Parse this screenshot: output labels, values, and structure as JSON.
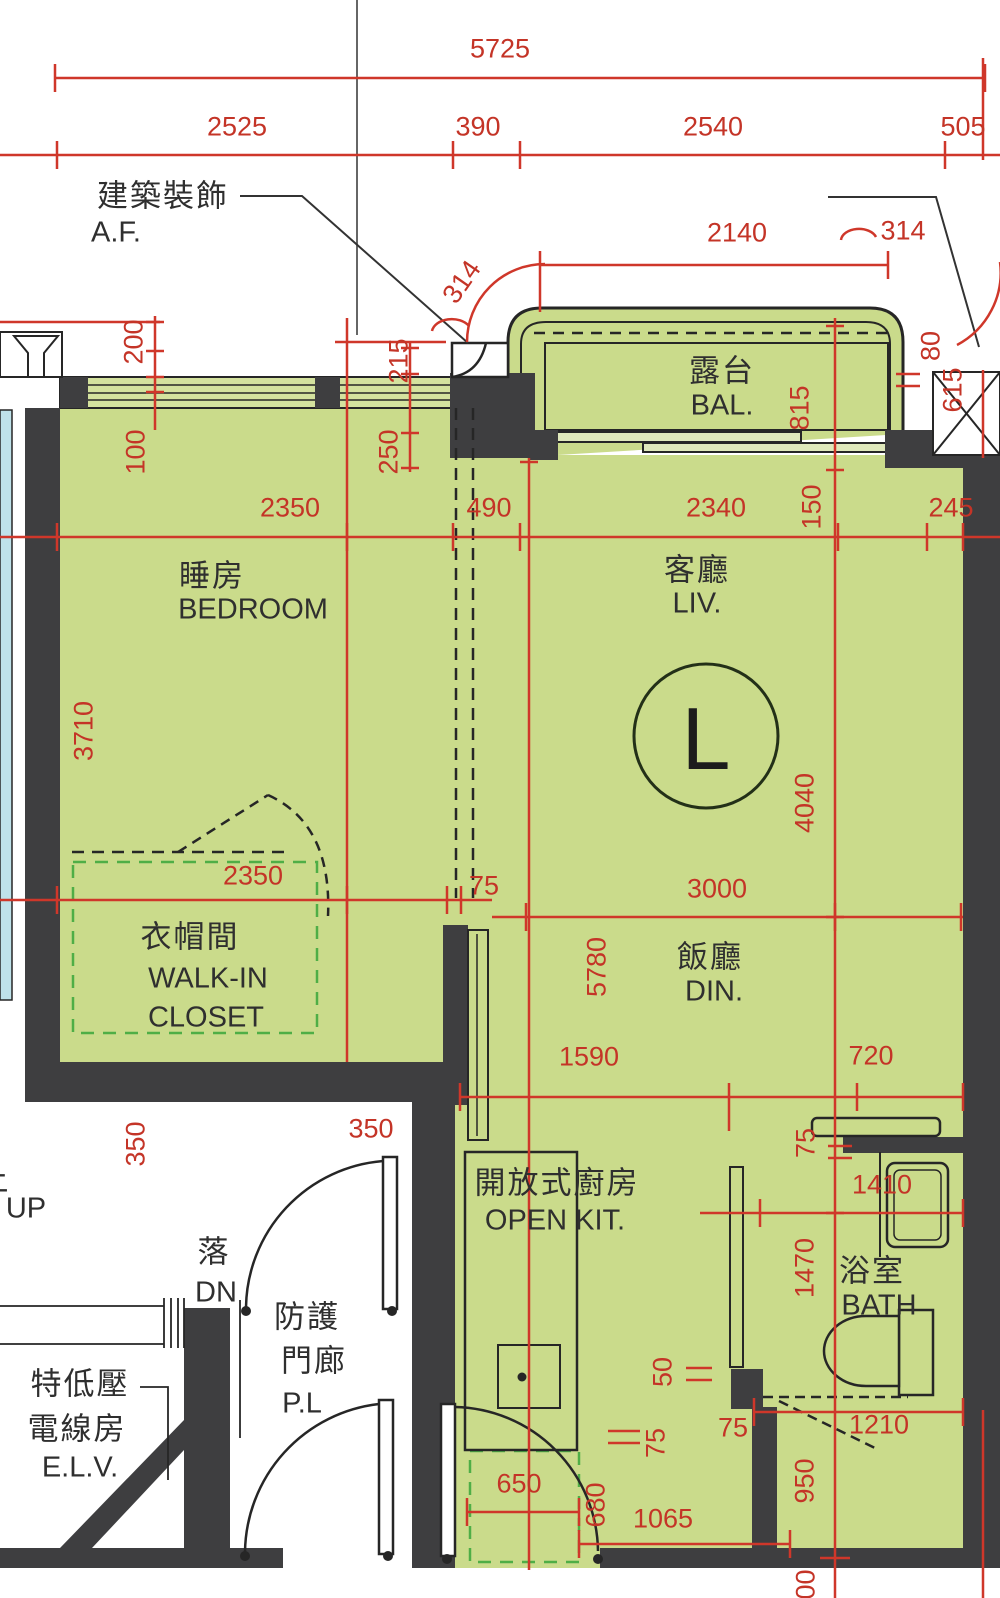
{
  "meta": {
    "drawing_type": "residential floor plan",
    "unit_label": "L"
  },
  "colors": {
    "floor_green": "#cadb8b",
    "window_band_green": "#d4e29e",
    "wall_dark": "#3e3e40",
    "dimension_red": "#cf372a",
    "dimension_text_red": "#c43427",
    "closet_dashed_green": "#4fae46",
    "adjacent_glazing_cyan": "#bfe2ea",
    "line_black": "#262626"
  },
  "rooms": [
    {
      "name_zh": "露台",
      "name_en": "BAL."
    },
    {
      "name_zh": "睡房",
      "name_en": "BEDROOM"
    },
    {
      "name_zh": "客廳",
      "name_en": "LIV."
    },
    {
      "name_zh": "飯廳",
      "name_en": "DIN."
    },
    {
      "name_zh": "衣帽間",
      "name_en": "WALK-IN CLOSET"
    },
    {
      "name_zh": "開放式廚房",
      "name_en": "OPEN KIT."
    },
    {
      "name_zh": "浴室",
      "name_en": "BATH"
    },
    {
      "name_zh": "防護門廊",
      "name_en": "P.L"
    },
    {
      "name_zh": "特低壓電線房",
      "name_en": "E.L.V."
    }
  ],
  "annotations": {
    "architectural_feature_zh": "建築裝飾",
    "architectural_feature_en": "A.F.",
    "stair_up": "UP",
    "stair_down_zh": "落",
    "stair_down_en": "DN",
    "unit_circle": "L"
  },
  "dimensions_mm": [
    5725,
    2525,
    390,
    2540,
    505,
    2140,
    314,
    314,
    215,
    200,
    100,
    250,
    815,
    80,
    615,
    150,
    2350,
    490,
    2340,
    245,
    3710,
    4040,
    2350,
    75,
    3000,
    5780,
    1590,
    720,
    75,
    1410,
    1470,
    350,
    350,
    50,
    75,
    75,
    1210,
    950,
    650,
    680,
    1065,
    100
  ],
  "labels": [
    {
      "name": "dim-5725",
      "text": "5725",
      "x": 500,
      "y": 49,
      "rot": 0,
      "cls": "dim"
    },
    {
      "name": "dim-2525",
      "text": "2525",
      "x": 237,
      "y": 127,
      "rot": 0,
      "cls": "dim"
    },
    {
      "name": "dim-390",
      "text": "390",
      "x": 478,
      "y": 127,
      "rot": 0,
      "cls": "dim"
    },
    {
      "name": "dim-2540",
      "text": "2540",
      "x": 713,
      "y": 127,
      "rot": 0,
      "cls": "dim"
    },
    {
      "name": "dim-505",
      "text": "505",
      "x": 963,
      "y": 127,
      "rot": 0,
      "cls": "dim"
    },
    {
      "name": "dim-2140",
      "text": "2140",
      "x": 737,
      "y": 233,
      "rot": 0,
      "cls": "dim"
    },
    {
      "name": "dim-314-right",
      "text": "314",
      "x": 903,
      "y": 231,
      "rot": 0,
      "cls": "dim"
    },
    {
      "name": "dim-314-left",
      "text": "314",
      "x": 462,
      "y": 282,
      "rot": -55,
      "cls": "dim"
    },
    {
      "name": "dim-215",
      "text": "215",
      "x": 399,
      "y": 361,
      "rot": -90,
      "cls": "dim"
    },
    {
      "name": "dim-200",
      "text": "200",
      "x": 134,
      "y": 342,
      "rot": -90,
      "cls": "dim"
    },
    {
      "name": "dim-100-top",
      "text": "100",
      "x": 136,
      "y": 452,
      "rot": -90,
      "cls": "dim"
    },
    {
      "name": "dim-250",
      "text": "250",
      "x": 389,
      "y": 452,
      "rot": -90,
      "cls": "dim"
    },
    {
      "name": "dim-815",
      "text": "815",
      "x": 800,
      "y": 408,
      "rot": -90,
      "cls": "dim"
    },
    {
      "name": "dim-80",
      "text": "80",
      "x": 931,
      "y": 346,
      "rot": -90,
      "cls": "dim"
    },
    {
      "name": "dim-615",
      "text": "615",
      "x": 953,
      "y": 390,
      "rot": -90,
      "cls": "dim"
    },
    {
      "name": "dim-150",
      "text": "150",
      "x": 812,
      "y": 507,
      "rot": -90,
      "cls": "dim"
    },
    {
      "name": "dim-2350-bedroom",
      "text": "2350",
      "x": 290,
      "y": 508,
      "rot": 0,
      "cls": "dim"
    },
    {
      "name": "dim-490",
      "text": "490",
      "x": 489,
      "y": 508,
      "rot": 0,
      "cls": "dim"
    },
    {
      "name": "dim-2340",
      "text": "2340",
      "x": 716,
      "y": 508,
      "rot": 0,
      "cls": "dim"
    },
    {
      "name": "dim-245",
      "text": "245",
      "x": 951,
      "y": 508,
      "rot": 0,
      "cls": "dim"
    },
    {
      "name": "dim-3710",
      "text": "3710",
      "x": 84,
      "y": 731,
      "rot": -90,
      "cls": "dim"
    },
    {
      "name": "dim-4040",
      "text": "4040",
      "x": 805,
      "y": 803,
      "rot": -90,
      "cls": "dim"
    },
    {
      "name": "dim-2350-closet",
      "text": "2350",
      "x": 253,
      "y": 876,
      "rot": 0,
      "cls": "dim"
    },
    {
      "name": "dim-75-closet",
      "text": "75",
      "x": 484,
      "y": 886,
      "rot": 0,
      "cls": "dim"
    },
    {
      "name": "dim-3000",
      "text": "3000",
      "x": 717,
      "y": 889,
      "rot": 0,
      "cls": "dim"
    },
    {
      "name": "dim-5780",
      "text": "5780",
      "x": 597,
      "y": 967,
      "rot": -90,
      "cls": "dim"
    },
    {
      "name": "dim-1590",
      "text": "1590",
      "x": 589,
      "y": 1057,
      "rot": 0,
      "cls": "dim"
    },
    {
      "name": "dim-720",
      "text": "720",
      "x": 871,
      "y": 1056,
      "rot": 0,
      "cls": "dim"
    },
    {
      "name": "dim-75-bath-top",
      "text": "75",
      "x": 806,
      "y": 1143,
      "rot": -90,
      "cls": "dim"
    },
    {
      "name": "dim-1410",
      "text": "1410",
      "x": 882,
      "y": 1185,
      "rot": 0,
      "cls": "dim"
    },
    {
      "name": "dim-1470",
      "text": "1470",
      "x": 805,
      "y": 1268,
      "rot": -90,
      "cls": "dim"
    },
    {
      "name": "dim-350-left",
      "text": "350",
      "x": 136,
      "y": 1144,
      "rot": -90,
      "cls": "dim"
    },
    {
      "name": "dim-350-right",
      "text": "350",
      "x": 371,
      "y": 1129,
      "rot": 0,
      "cls": "dim"
    },
    {
      "name": "dim-50",
      "text": "50",
      "x": 663,
      "y": 1372,
      "rot": -90,
      "cls": "dim"
    },
    {
      "name": "dim-75-door",
      "text": "75",
      "x": 656,
      "y": 1443,
      "rot": -90,
      "cls": "dim"
    },
    {
      "name": "dim-75-bathwall",
      "text": "75",
      "x": 733,
      "y": 1428,
      "rot": 0,
      "cls": "dim"
    },
    {
      "name": "dim-1210",
      "text": "1210",
      "x": 879,
      "y": 1425,
      "rot": 0,
      "cls": "dim"
    },
    {
      "name": "dim-950",
      "text": "950",
      "x": 805,
      "y": 1481,
      "rot": -90,
      "cls": "dim"
    },
    {
      "name": "dim-650",
      "text": "650",
      "x": 519,
      "y": 1484,
      "rot": 0,
      "cls": "dim"
    },
    {
      "name": "dim-680",
      "text": "680",
      "x": 596,
      "y": 1505,
      "rot": -90,
      "cls": "dim"
    },
    {
      "name": "dim-1065",
      "text": "1065",
      "x": 663,
      "y": 1519,
      "rot": 0,
      "cls": "dim"
    },
    {
      "name": "dim-100-bottom",
      "text": "100",
      "x": 806,
      "y": 1592,
      "rot": -90,
      "cls": "dim"
    },
    {
      "name": "label-af-zh",
      "text": "建築裝飾",
      "x": 163,
      "y": 196,
      "rot": 0,
      "cls": "zh"
    },
    {
      "name": "label-af-en",
      "text": "A.F.",
      "x": 116,
      "y": 233,
      "rot": 0,
      "cls": "en"
    },
    {
      "name": "label-bal-zh",
      "text": "露台",
      "x": 722,
      "y": 371,
      "rot": 0,
      "cls": "zh"
    },
    {
      "name": "label-bal-en",
      "text": "BAL.",
      "x": 722,
      "y": 406,
      "rot": 0,
      "cls": "en"
    },
    {
      "name": "label-bedroom-zh",
      "text": "睡房",
      "x": 212,
      "y": 576,
      "rot": 0,
      "cls": "zh"
    },
    {
      "name": "label-bedroom-en",
      "text": "BEDROOM",
      "x": 253,
      "y": 610,
      "rot": 0,
      "cls": "en"
    },
    {
      "name": "label-liv-zh",
      "text": "客廳",
      "x": 697,
      "y": 570,
      "rot": 0,
      "cls": "zh"
    },
    {
      "name": "label-liv-en",
      "text": "LIV.",
      "x": 697,
      "y": 604,
      "rot": 0,
      "cls": "en"
    },
    {
      "name": "label-unit-circle",
      "text": "L",
      "x": 706,
      "y": 739,
      "rot": 0,
      "cls": "big"
    },
    {
      "name": "label-din-zh",
      "text": "飯廳",
      "x": 710,
      "y": 957,
      "rot": 0,
      "cls": "zh"
    },
    {
      "name": "label-din-en",
      "text": "DIN.",
      "x": 714,
      "y": 992,
      "rot": 0,
      "cls": "en"
    },
    {
      "name": "label-closet-zh",
      "text": "衣帽間",
      "x": 190,
      "y": 937,
      "rot": 0,
      "cls": "zh"
    },
    {
      "name": "label-closet-en1",
      "text": "WALK-IN",
      "x": 208,
      "y": 979,
      "rot": 0,
      "cls": "en"
    },
    {
      "name": "label-closet-en2",
      "text": "CLOSET",
      "x": 206,
      "y": 1018,
      "rot": 0,
      "cls": "en"
    },
    {
      "name": "label-kitchen-zh",
      "text": "開放式廚房",
      "x": 557,
      "y": 1183,
      "rot": 0,
      "cls": "zh"
    },
    {
      "name": "label-kitchen-en",
      "text": "OPEN KIT.",
      "x": 555,
      "y": 1221,
      "rot": 0,
      "cls": "en"
    },
    {
      "name": "label-bath-zh",
      "text": "浴室",
      "x": 872,
      "y": 1271,
      "rot": 0,
      "cls": "zh"
    },
    {
      "name": "label-bath-en",
      "text": "BATH",
      "x": 879,
      "y": 1306,
      "rot": 0,
      "cls": "en"
    },
    {
      "name": "label-pl-zh1",
      "text": "防護",
      "x": 307,
      "y": 1317,
      "rot": 0,
      "cls": "zh"
    },
    {
      "name": "label-pl-zh2",
      "text": "門廊",
      "x": 314,
      "y": 1361,
      "rot": 0,
      "cls": "zh"
    },
    {
      "name": "label-pl-en",
      "text": "P.L",
      "x": 302,
      "y": 1404,
      "rot": 0,
      "cls": "en"
    },
    {
      "name": "label-elv-zh1",
      "text": "特低壓",
      "x": 80,
      "y": 1384,
      "rot": 0,
      "cls": "zh"
    },
    {
      "name": "label-elv-zh2",
      "text": "電線房",
      "x": 77,
      "y": 1429,
      "rot": 0,
      "cls": "zh"
    },
    {
      "name": "label-elv-en",
      "text": "E.L.V.",
      "x": 80,
      "y": 1468,
      "rot": 0,
      "cls": "en"
    },
    {
      "name": "label-dn-zh",
      "text": "落",
      "x": 214,
      "y": 1252,
      "rot": 0,
      "cls": "zh"
    },
    {
      "name": "label-dn-en",
      "text": "DN",
      "x": 216,
      "y": 1293,
      "rot": 0,
      "cls": "en"
    },
    {
      "name": "label-up",
      "text": "UP",
      "x": 26,
      "y": 1209,
      "rot": 0,
      "cls": "en"
    },
    {
      "name": "label-up-partial",
      "text": "上",
      "x": -6,
      "y": 1180,
      "rot": 0,
      "cls": "zh"
    }
  ]
}
